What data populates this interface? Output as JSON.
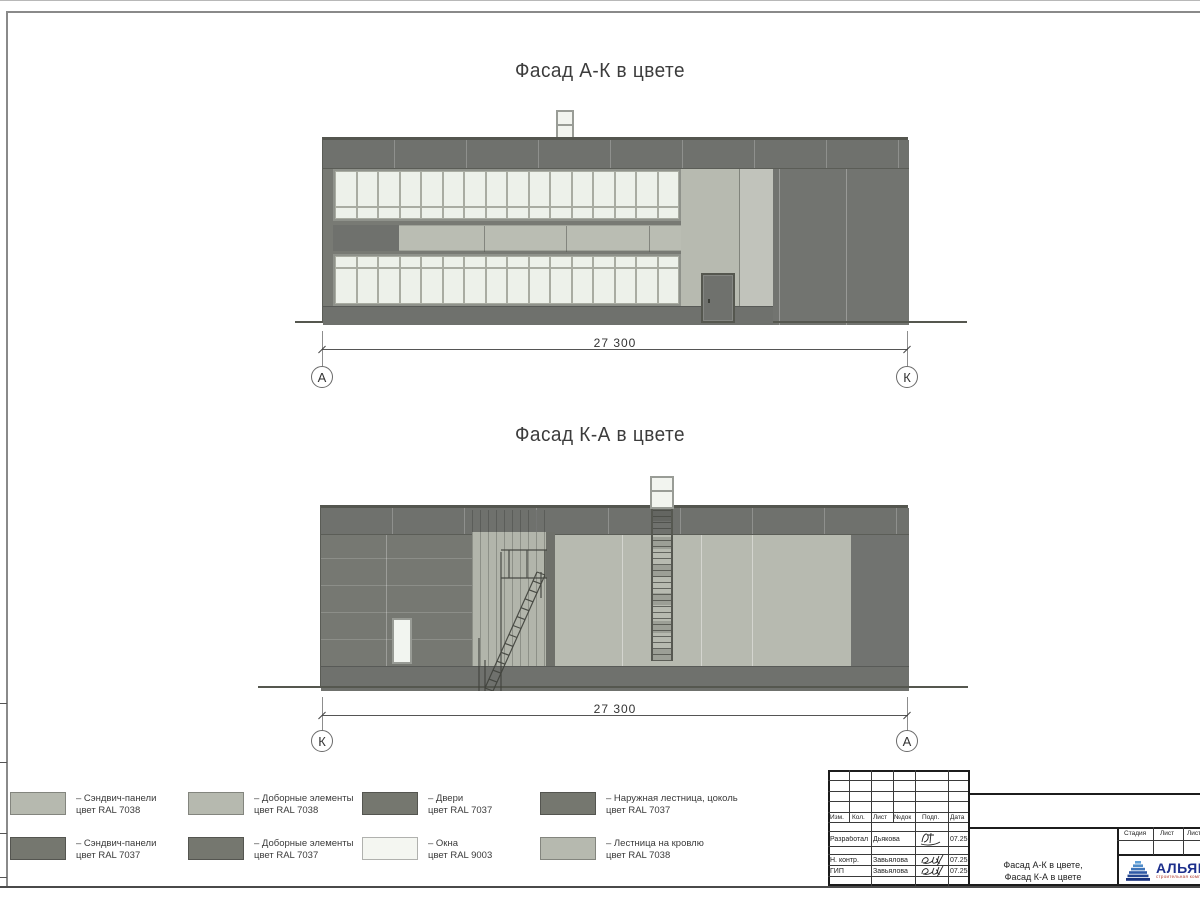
{
  "titles": {
    "facade1": "Фасад А-К в цвете",
    "facade2": "Фасад К-А в цвете"
  },
  "dimensions": {
    "facade1": "27 300",
    "facade2": "27 300"
  },
  "grid_markers": {
    "facade1_left": "А",
    "facade1_right": "К",
    "facade2_left": "К",
    "facade2_right": "А"
  },
  "colors": {
    "ral7038_light_gray": "#b6b9af",
    "ral7037_dark_gray": "#75776f",
    "ral9003_white": "#f4f6f1",
    "logo_blue": "#1c2f8c",
    "logo_red": "#b03a2e"
  },
  "legend": {
    "items": [
      {
        "label": "– Сэндвич-панели",
        "sub": "цвет RAL 7038",
        "color": "#b6b9af"
      },
      {
        "label": "– Доборные элементы",
        "sub": "цвет RAL 7038",
        "color": "#b6b9af"
      },
      {
        "label": "– Двери",
        "sub": "цвет RAL 7037",
        "color": "#75776f"
      },
      {
        "label": "– Наружная лестница, цоколь",
        "sub": "цвет RAL 7037",
        "color": "#75776f"
      },
      {
        "label": "– Сэндвич-панели",
        "sub": "цвет RAL 7037",
        "color": "#75776f"
      },
      {
        "label": "– Доборные элементы",
        "sub": "цвет RAL 7037",
        "color": "#75776f"
      },
      {
        "label": "– Окна",
        "sub": "цвет RAL 9003",
        "color": "#f4f6f1"
      },
      {
        "label": "– Лестница на кровлю",
        "sub": "цвет RAL 7038",
        "color": "#b6b9af"
      }
    ]
  },
  "title_block": {
    "header_cols": [
      "Изм.",
      "Кол.",
      "Лист",
      "№док",
      "Подп.",
      "Дата"
    ],
    "rows": [
      {
        "role": "Разработал",
        "name": "Дьякова",
        "date": "07.25"
      },
      {
        "role": "Н. контр.",
        "name": "Завьялова",
        "date": "07.25"
      },
      {
        "role": "ГИП",
        "name": "Завьялова",
        "date": "07.25"
      }
    ],
    "doc_title_line1": "Фасад А-К в цвете,",
    "doc_title_line2": "Фасад К-А в цвете",
    "stage_cols": [
      "Стадия",
      "Лист",
      "Листов"
    ],
    "company": {
      "name": "АЛЬЯНС",
      "tagline": "строительная компания"
    }
  }
}
